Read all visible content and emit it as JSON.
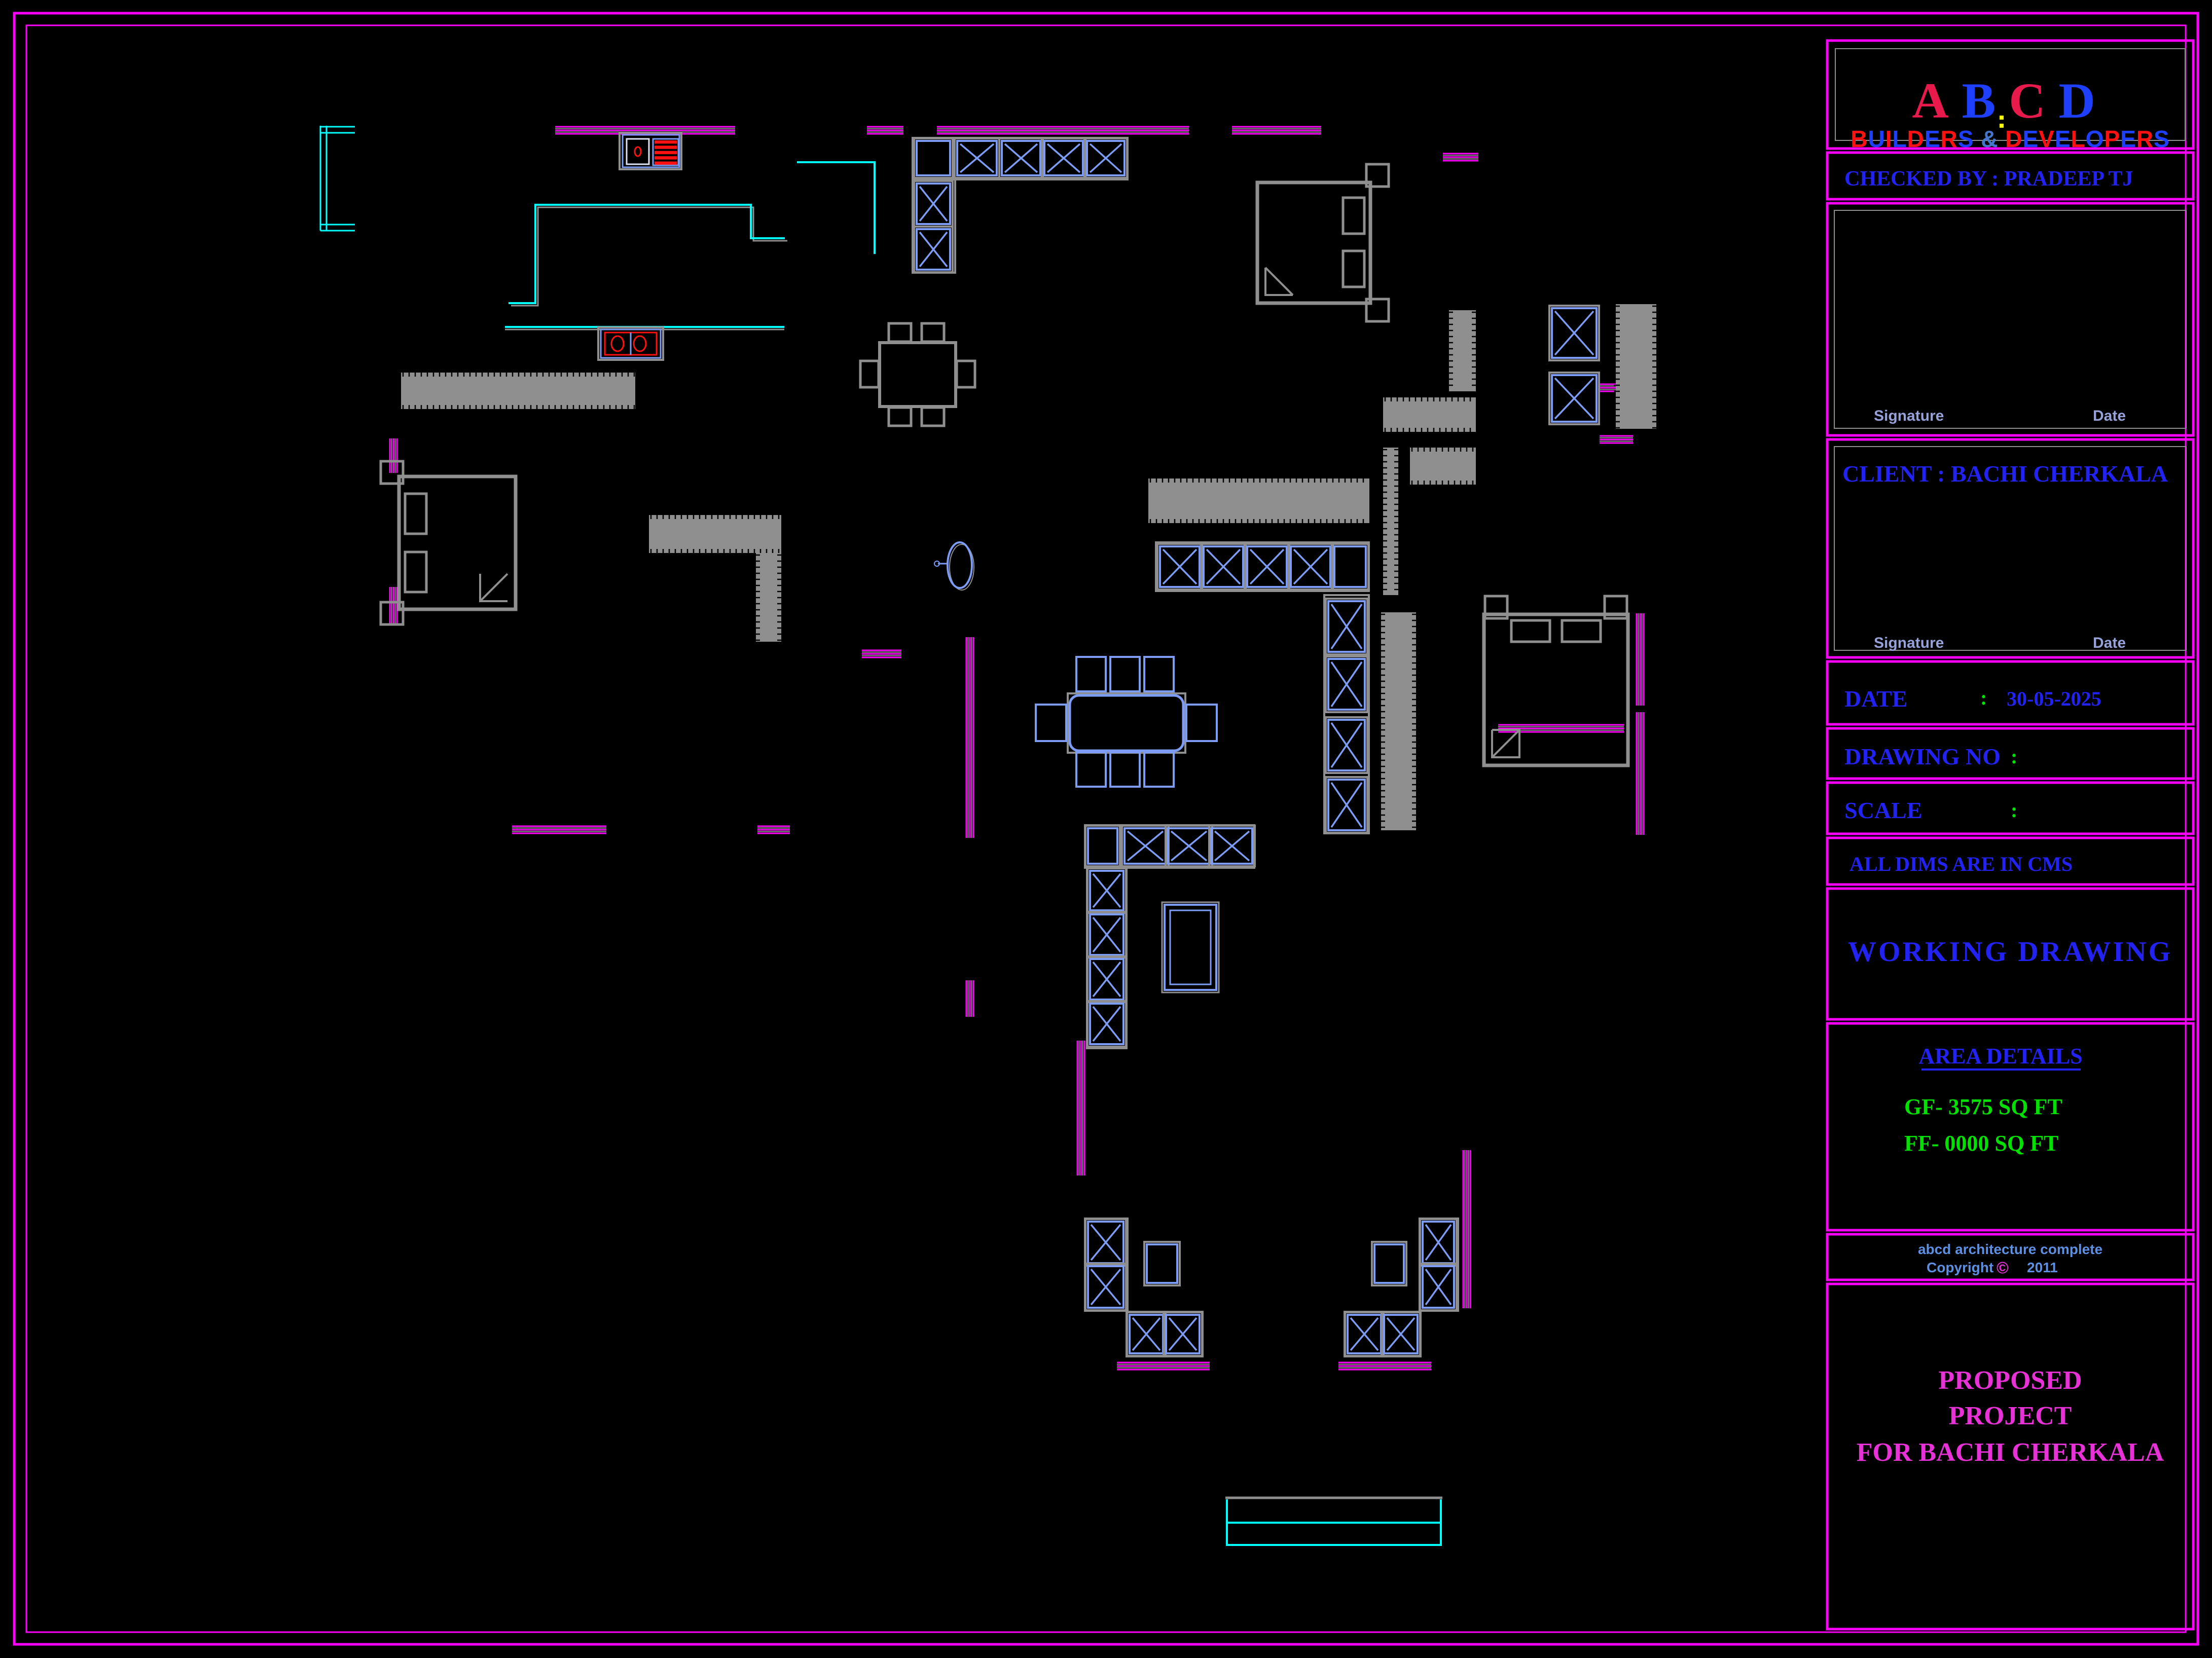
{
  "tb": {
    "logo_top_letters": [
      [
        "A",
        "#e8194b"
      ],
      [
        "B",
        "#1f3fff"
      ],
      [
        "C",
        "#e8194b"
      ],
      [
        "D",
        "#1f3fff"
      ]
    ],
    "logo_bottom_letters": [
      [
        "B",
        "#ff1111"
      ],
      [
        "U",
        "#1f3fff"
      ],
      [
        "I",
        "#ff1111"
      ],
      [
        "L",
        "#1f3fff"
      ],
      [
        "D",
        "#ff1111"
      ],
      [
        "E",
        "#1f3fff"
      ],
      [
        "R",
        "#ff1111"
      ],
      [
        "S",
        "#1f3fff"
      ],
      [
        " ",
        "#000"
      ],
      [
        "&",
        "#4477cc"
      ],
      [
        " ",
        "#000"
      ],
      [
        "D",
        "#ff1111"
      ],
      [
        "E",
        "#1f3fff"
      ],
      [
        "V",
        "#ff1111"
      ],
      [
        "E",
        "#1f3fff"
      ],
      [
        "L",
        "#ff1111"
      ],
      [
        "O",
        "#1f3fff"
      ],
      [
        "P",
        "#ff1111"
      ],
      [
        "E",
        "#1f3fff"
      ],
      [
        "R",
        "#ff1111"
      ],
      [
        "S",
        "#1f3fff"
      ]
    ],
    "checked_by": "CHECKED BY  : PRADEEP TJ",
    "signature_label": "Signature",
    "date_label_small": "Date",
    "client": "CLIENT    :    BACHI CHERKALA",
    "date_label": "DATE",
    "date_colon": ":",
    "date_value": "30-05-2025",
    "drawing_no_label": "DRAWING NO",
    "drawing_no_colon": ":",
    "drawing_no_value": "",
    "scale_label": "SCALE",
    "scale_colon": ":",
    "scale_value": "",
    "dims_note": "ALL DIMS ARE IN CMS",
    "working_drawing": "WORKING  DRAWING",
    "area_details_title": "AREA DETAILS",
    "area_gf": "GF- 3575 SQ FT",
    "area_ff": "FF- 0000 SQ FT",
    "firm_line": "abcd  architecture  complete",
    "copyright_word": "Copyright",
    "copyright_symbol": "©",
    "copyright_year": "2011",
    "proposed_1": "PROPOSED",
    "proposed_2": "PROJECT",
    "proposed_3": "FOR BACHI CHERKALA"
  },
  "colors": {
    "m": "#ff00ff",
    "c": "#00ffff",
    "b": "#7d9cf5",
    "g": "#8f8f8f",
    "r": "#ff1111",
    "G": "#00e100",
    "w": "#dde4f5",
    "y": "#ffff00"
  },
  "plan": {
    "shapes": [
      [
        "rc",
        28,
        26,
        4307,
        3218,
        "m",
        5
      ],
      [
        "rc",
        52,
        50,
        4259,
        3170,
        "m",
        3
      ],
      [
        "wh",
        1095,
        250,
        355
      ],
      [
        "wh",
        1710,
        250,
        72
      ],
      [
        "wh",
        1848,
        250,
        497
      ],
      [
        "wh",
        2430,
        250,
        176
      ],
      [
        "wh",
        2846,
        303,
        70
      ],
      [
        "wh",
        3152,
        758,
        68
      ],
      [
        "wh",
        3155,
        860,
        66
      ],
      [
        "wh",
        1700,
        1283,
        78
      ],
      [
        "wh",
        1010,
        1630,
        186
      ],
      [
        "wh",
        1494,
        1630,
        64
      ],
      [
        "wh",
        2955,
        1430,
        248
      ],
      [
        "wh",
        2203,
        2688,
        183
      ],
      [
        "wh",
        2640,
        2688,
        183
      ],
      [
        "wv",
        769,
        865,
        68
      ],
      [
        "wv",
        769,
        1158,
        75
      ],
      [
        "wv",
        1906,
        1257,
        396
      ],
      [
        "wv",
        1906,
        1934,
        72
      ],
      [
        "wv",
        2125,
        2053,
        266
      ],
      [
        "wv",
        2886,
        2269,
        312
      ],
      [
        "wv",
        3228,
        1210,
        182
      ],
      [
        "wv",
        3228,
        1405,
        242
      ],
      [
        "pl",
        [
          [
            632,
            248
          ],
          [
            632,
            455
          ]
        ],
        "c",
        3
      ],
      [
        "pl",
        [
          [
            644,
            248
          ],
          [
            644,
            455
          ]
        ],
        "c",
        3
      ],
      [
        "pl",
        [
          [
            632,
            250
          ],
          [
            700,
            250
          ]
        ],
        "c",
        3
      ],
      [
        "pl",
        [
          [
            632,
            262
          ],
          [
            700,
            262
          ]
        ],
        "c",
        3
      ],
      [
        "pl",
        [
          [
            632,
            443
          ],
          [
            700,
            443
          ]
        ],
        "c",
        3
      ],
      [
        "pl",
        [
          [
            632,
            455
          ],
          [
            700,
            455
          ]
        ],
        "c",
        3
      ],
      [
        "pl",
        [
          [
            1008,
            603
          ],
          [
            1061,
            603
          ],
          [
            1061,
            409
          ],
          [
            1486,
            409
          ],
          [
            1486,
            475
          ],
          [
            1553,
            475
          ]
        ],
        "g",
        3
      ],
      [
        "pl",
        [
          [
            1003,
            598
          ],
          [
            1056,
            598
          ],
          [
            1056,
            404
          ],
          [
            1481,
            404
          ],
          [
            1481,
            470
          ],
          [
            1548,
            470
          ]
        ],
        "c",
        4
      ],
      [
        "pl",
        [
          [
            1572,
            320
          ],
          [
            1725,
            320
          ],
          [
            1725,
            501
          ]
        ],
        "c",
        4
      ],
      [
        "pl",
        [
          [
            996,
            650
          ],
          [
            1547,
            650
          ]
        ],
        "g",
        3
      ],
      [
        "pl",
        [
          [
            996,
            645
          ],
          [
            1547,
            645
          ]
        ],
        "c",
        4
      ],
      [
        "ht",
        791,
        735,
        462,
        72
      ],
      [
        "ht",
        1280,
        1016,
        261,
        75
      ],
      [
        "ht",
        1491,
        1091,
        50,
        175
      ],
      [
        "ht",
        2265,
        944,
        436,
        88
      ],
      [
        "ht",
        2858,
        612,
        53,
        160
      ],
      [
        "ht",
        2728,
        784,
        183,
        68
      ],
      [
        "ht",
        2781,
        883,
        130,
        73
      ],
      [
        "ht",
        2728,
        883,
        30,
        291
      ],
      [
        "ht",
        2724,
        1208,
        69,
        430
      ],
      [
        "ht",
        3187,
        600,
        80,
        246
      ],
      [
        "rc",
        1800,
        272,
        424,
        82,
        "g",
        4
      ],
      [
        "pb",
        1808,
        278,
        66,
        68
      ],
      [
        "xb",
        1888,
        278,
        78,
        68
      ],
      [
        "xb",
        1976,
        278,
        76,
        68
      ],
      [
        "xb",
        2060,
        278,
        76,
        68
      ],
      [
        "xb",
        2144,
        278,
        74,
        68
      ],
      [
        "rc",
        1800,
        354,
        84,
        184,
        "g",
        4
      ],
      [
        "xb",
        1808,
        362,
        66,
        80
      ],
      [
        "xb",
        1808,
        452,
        66,
        80
      ],
      [
        "rc",
        2280,
        1070,
        420,
        96,
        "g",
        4
      ],
      [
        "xb",
        2288,
        1078,
        78,
        80
      ],
      [
        "xb",
        2374,
        1078,
        78,
        80
      ],
      [
        "xb",
        2460,
        1078,
        78,
        80
      ],
      [
        "xb",
        2546,
        1078,
        78,
        80
      ],
      [
        "pb",
        2632,
        1078,
        62,
        80
      ],
      [
        "rc",
        2612,
        1174,
        88,
        470,
        "g",
        4
      ],
      [
        "xb",
        2620,
        1186,
        72,
        100
      ],
      [
        "xb",
        2620,
        1300,
        72,
        100
      ],
      [
        "xb",
        2620,
        1420,
        72,
        100
      ],
      [
        "xb",
        2620,
        1538,
        72,
        100
      ],
      [
        "rc",
        2140,
        1628,
        334,
        84,
        "g",
        4
      ],
      [
        "pb",
        2146,
        1634,
        58,
        70
      ],
      [
        "xb",
        2218,
        1634,
        82,
        70
      ],
      [
        "xb",
        2304,
        1634,
        82,
        70
      ],
      [
        "xb",
        2390,
        1634,
        80,
        70
      ],
      [
        "rc",
        2144,
        1712,
        78,
        356,
        "g",
        4
      ],
      [
        "xb",
        2150,
        1718,
        66,
        78
      ],
      [
        "xb",
        2150,
        1804,
        66,
        80
      ],
      [
        "xb",
        2150,
        1892,
        66,
        80
      ],
      [
        "xb",
        2150,
        1980,
        66,
        80
      ],
      [
        "rc",
        2292,
        1780,
        112,
        178,
        "g",
        3
      ],
      [
        "rc",
        2297,
        1785,
        102,
        168,
        "b",
        4
      ],
      [
        "rc",
        2308,
        1796,
        80,
        146,
        "b",
        3
      ],
      [
        "rc",
        2140,
        2404,
        84,
        182,
        "g",
        4
      ],
      [
        "xb",
        2146,
        2410,
        70,
        82
      ],
      [
        "xb",
        2146,
        2498,
        70,
        82
      ],
      [
        "pb",
        2262,
        2455,
        60,
        76
      ],
      [
        "rc",
        2222,
        2588,
        150,
        88,
        "g",
        4
      ],
      [
        "xb",
        2228,
        2594,
        66,
        76
      ],
      [
        "xb",
        2300,
        2594,
        66,
        76
      ],
      [
        "pb",
        2711,
        2455,
        58,
        76
      ],
      [
        "rc",
        2800,
        2404,
        76,
        182,
        "g",
        4
      ],
      [
        "xb",
        2806,
        2410,
        62,
        82
      ],
      [
        "xb",
        2806,
        2498,
        62,
        82
      ],
      [
        "rc",
        2652,
        2588,
        150,
        88,
        "g",
        4
      ],
      [
        "xb",
        2658,
        2594,
        66,
        76
      ],
      [
        "xb",
        2730,
        2594,
        66,
        76
      ],
      [
        "xb",
        3061,
        608,
        88,
        98
      ],
      [
        "xb",
        3061,
        740,
        88,
        92
      ],
      [
        "bd",
        787,
        940,
        230,
        262,
        "L"
      ],
      [
        "bd",
        2480,
        360,
        223,
        238,
        "R"
      ],
      [
        "bd",
        2927,
        1212,
        284,
        298,
        "T"
      ],
      [
        "rc",
        1735,
        676,
        150,
        126,
        "g",
        6
      ],
      [
        "gb",
        1753,
        638,
        44,
        36
      ],
      [
        "gb",
        1818,
        638,
        44,
        36
      ],
      [
        "gb",
        1753,
        804,
        44,
        36
      ],
      [
        "gb",
        1818,
        804,
        44,
        36
      ],
      [
        "gb",
        1697,
        712,
        36,
        52
      ],
      [
        "gb",
        1887,
        712,
        36,
        52
      ],
      [
        "rc",
        2106,
        1368,
        232,
        117,
        "g",
        4
      ],
      [
        "rc",
        2110,
        1372,
        224,
        109,
        "b",
        5,
        18
      ],
      [
        "bb",
        2123,
        1296,
        58,
        68
      ],
      [
        "bb",
        2190,
        1296,
        58,
        68
      ],
      [
        "bb",
        2257,
        1296,
        58,
        68
      ],
      [
        "bb",
        2123,
        1484,
        58,
        68
      ],
      [
        "bb",
        2190,
        1484,
        58,
        68
      ],
      [
        "bb",
        2257,
        1484,
        58,
        68
      ],
      [
        "bb",
        2043,
        1390,
        60,
        72
      ],
      [
        "bb",
        2340,
        1390,
        60,
        72
      ],
      [
        "rc",
        1222,
        262,
        122,
        72,
        "g",
        4
      ],
      [
        "rc",
        1228,
        266,
        112,
        64,
        "b",
        3
      ],
      [
        "rc",
        1236,
        274,
        44,
        50,
        "w",
        3
      ],
      [
        "el",
        1258,
        299,
        6,
        9,
        "r",
        3
      ],
      [
        "rl",
        1288,
        274,
        50,
        52,
        5
      ],
      [
        "rc",
        1180,
        646,
        128,
        64,
        "g",
        4
      ],
      [
        "rc",
        1185,
        650,
        118,
        56,
        "b",
        3
      ],
      [
        "rc",
        1193,
        656,
        102,
        44,
        "r",
        3
      ],
      [
        "pl",
        [
          [
            1244,
            656
          ],
          [
            1244,
            700
          ]
        ],
        "b",
        3
      ],
      [
        "el",
        1218,
        678,
        12,
        15,
        "r",
        3
      ],
      [
        "el",
        1262,
        678,
        12,
        15,
        "r",
        3
      ],
      [
        "el",
        1897,
        1119,
        24,
        45,
        "g",
        2
      ],
      [
        "el",
        1893,
        1115,
        24,
        45,
        "b",
        4
      ],
      [
        "pl",
        [
          [
            1869,
            1112
          ],
          [
            1850,
            1112
          ]
        ],
        "b",
        3
      ],
      [
        "el",
        1848,
        1112,
        5,
        5,
        "b",
        2
      ],
      [
        "pl",
        [
          [
            2417,
            2955
          ],
          [
            2845,
            2955
          ]
        ],
        "g",
        5
      ],
      [
        "pl",
        [
          [
            2420,
            2958
          ],
          [
            2420,
            3048
          ],
          [
            2842,
            3048
          ],
          [
            2842,
            2958
          ]
        ],
        "c",
        4
      ],
      [
        "pl",
        [
          [
            2420,
            3004
          ],
          [
            2842,
            3004
          ]
        ],
        "c",
        4
      ],
      [
        "rc",
        3604,
        80,
        722,
        213,
        "m",
        5
      ],
      [
        "rc",
        3620,
        96,
        690,
        181,
        "g",
        2
      ],
      [
        "rc",
        3604,
        301,
        722,
        92,
        "m",
        5
      ],
      [
        "rc",
        3604,
        401,
        722,
        458,
        "m",
        5
      ],
      [
        "rc",
        3618,
        415,
        694,
        430,
        "g",
        2
      ],
      [
        "rc",
        3604,
        867,
        722,
        430,
        "m",
        5
      ],
      [
        "rc",
        3618,
        881,
        694,
        402,
        "g",
        2
      ],
      [
        "rc",
        3604,
        1305,
        722,
        124,
        "m",
        5
      ],
      [
        "rc",
        3604,
        1437,
        722,
        99,
        "m",
        5
      ],
      [
        "rc",
        3604,
        1544,
        722,
        101,
        "m",
        5
      ],
      [
        "rc",
        3604,
        1653,
        722,
        92,
        "m",
        5
      ],
      [
        "rc",
        3604,
        1753,
        722,
        258,
        "m",
        5
      ],
      [
        "rc",
        3604,
        2019,
        722,
        408,
        "m",
        5
      ],
      [
        "rc",
        3604,
        2435,
        722,
        90,
        "m",
        5
      ],
      [
        "rc",
        3604,
        2533,
        722,
        681,
        "m",
        5
      ],
      [
        "pl",
        [
          [
            3790,
            2110
          ],
          [
            4104,
            2110
          ]
        ],
        "bl",
        4
      ],
      [
        "rc",
        3944,
        228,
        8,
        8,
        "y",
        0
      ],
      [
        "rc",
        3944,
        244,
        8,
        8,
        "y",
        0
      ]
    ]
  }
}
